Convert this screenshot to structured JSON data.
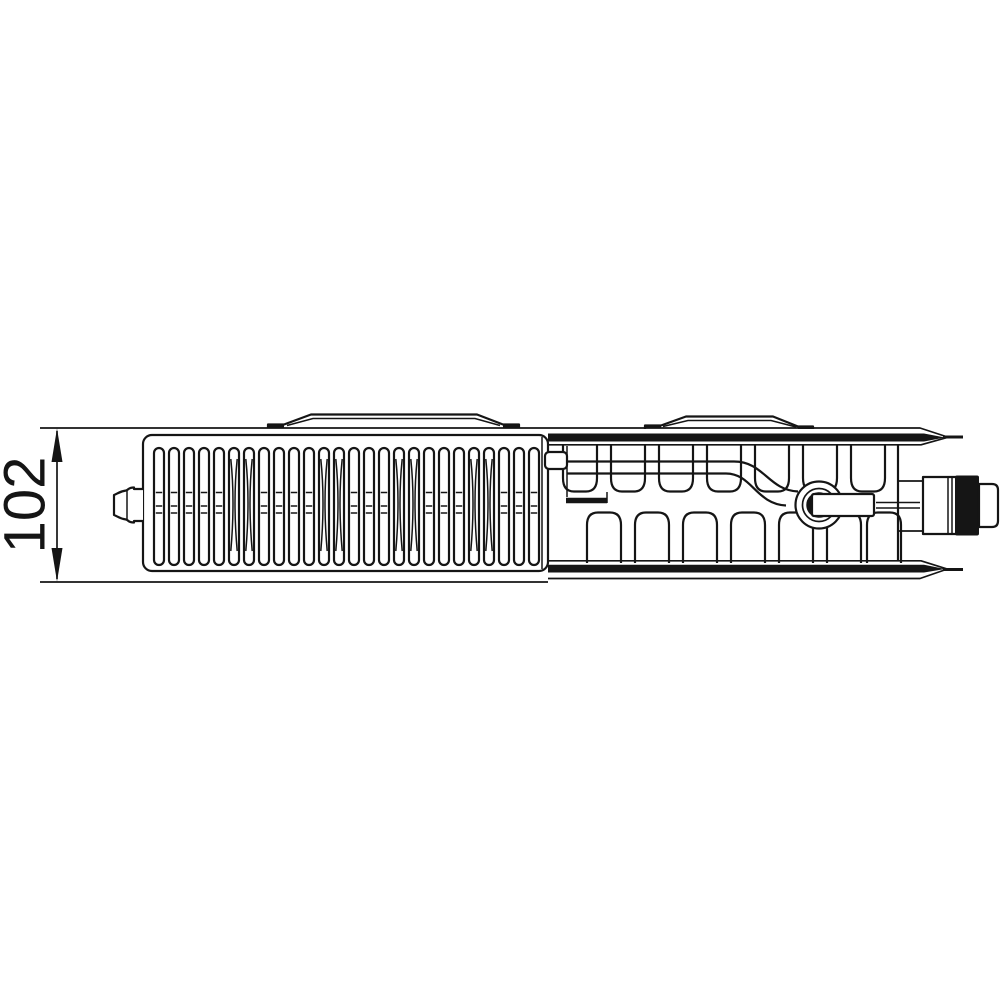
{
  "page": {
    "background": "#ffffff"
  },
  "drawing": {
    "type": "technical-line-drawing",
    "subject": "panel-radiator-top-section-view",
    "line_color": "#151515",
    "dimension": {
      "label": "102"
    },
    "grille": {
      "slot_count": 26,
      "waist_slot_indices": [
        5,
        6,
        11,
        12,
        16,
        17,
        21,
        22
      ],
      "bar_levels": [
        492.5,
        506,
        513
      ]
    },
    "convector": {
      "upper_fin_count": 7,
      "lower_fin_count": 7
    },
    "bracket_count": 2
  }
}
